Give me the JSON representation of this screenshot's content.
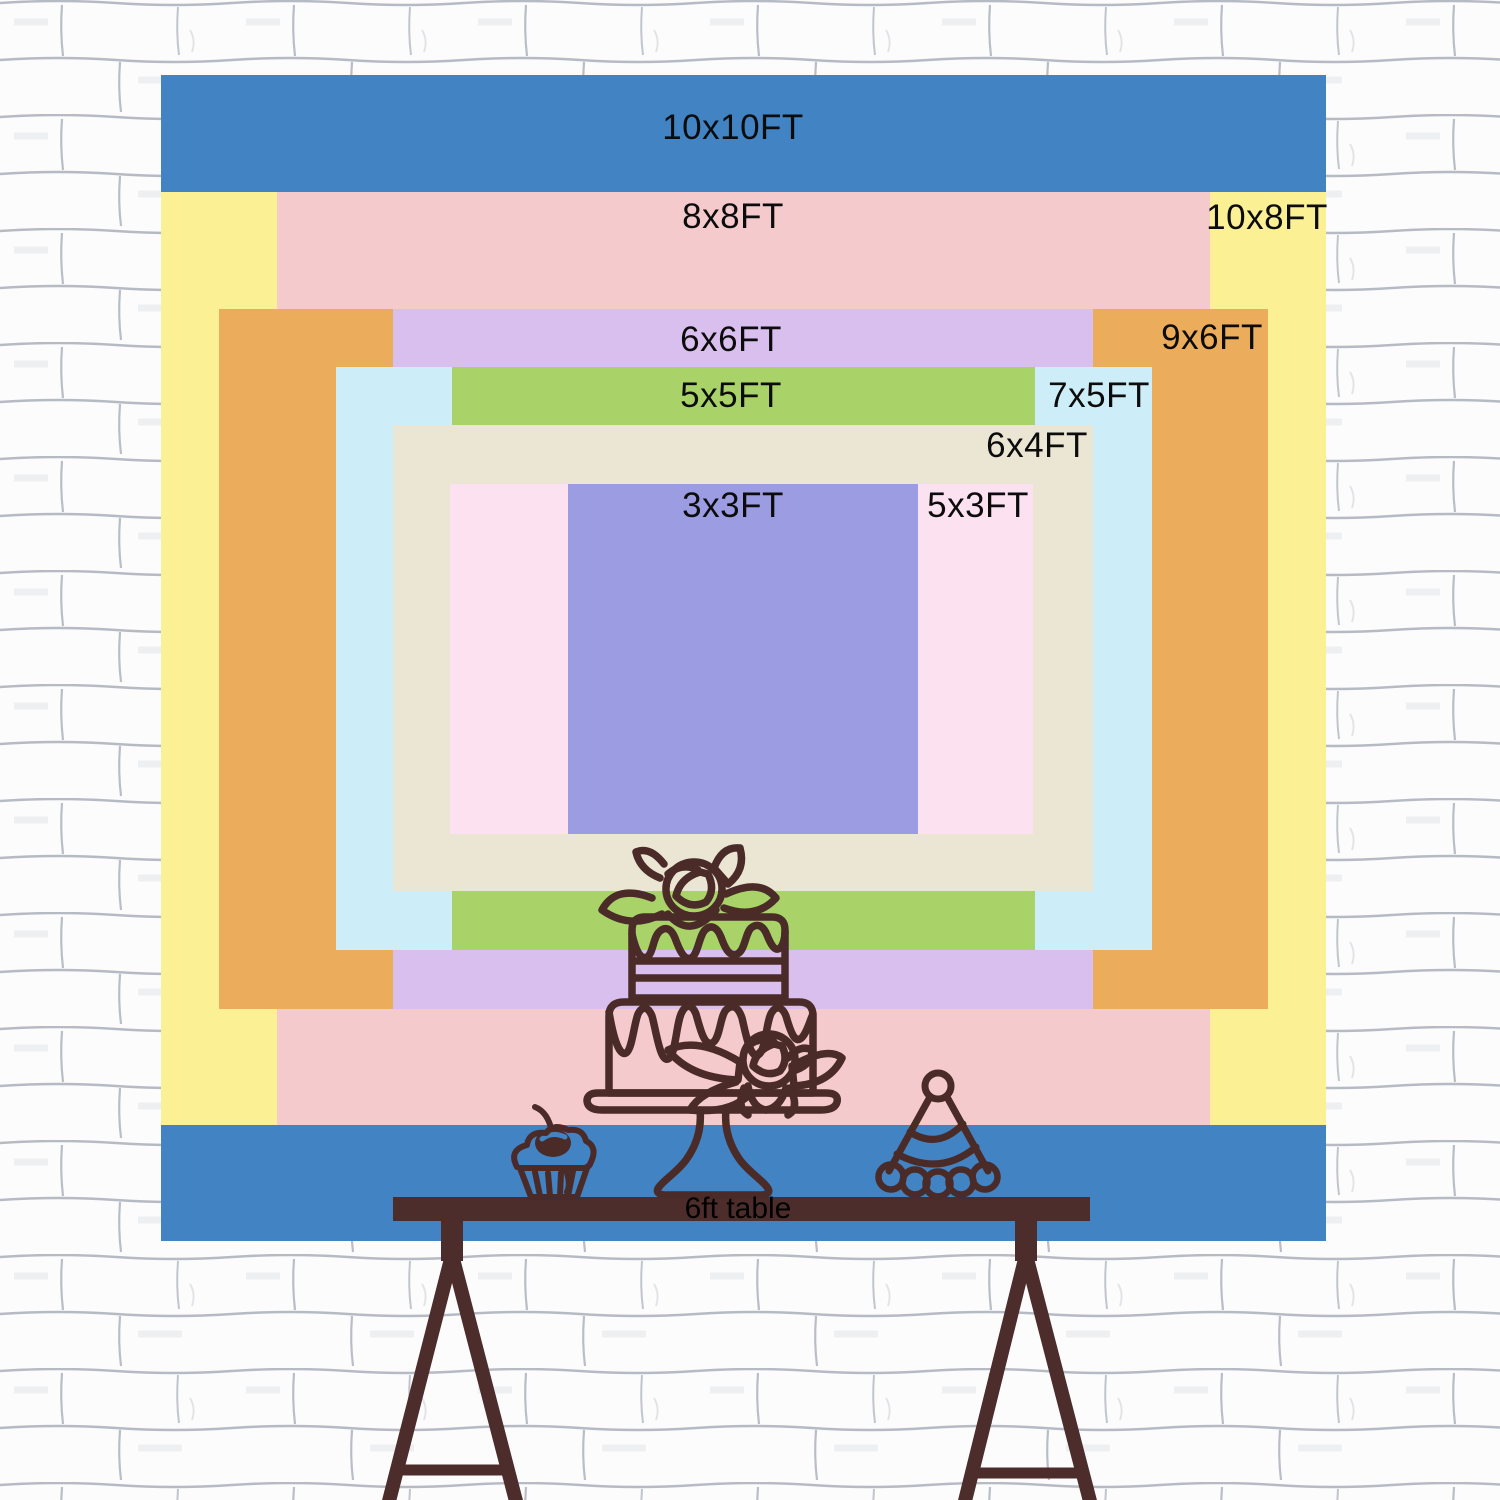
{
  "sizes": {
    "rects": [
      {
        "size": "10x10FT",
        "color": "#4183C3"
      },
      {
        "size": "10x8FT",
        "color": "#FBF094"
      },
      {
        "size": "8x8FT",
        "color": "#F4CACD"
      },
      {
        "size": "9x6FT",
        "color": "#EBAD5C"
      },
      {
        "size": "6x6FT",
        "color": "#D9BFED"
      },
      {
        "size": "7x5FT",
        "color": "#CDEEF8"
      },
      {
        "size": "5x5FT",
        "color": "#A9D369"
      },
      {
        "size": "6x4FT",
        "color": "#EBE6D4"
      },
      {
        "size": "5x3FT",
        "color": "#FCE1F0"
      },
      {
        "size": "3x3FT",
        "color": "#9C9CE2"
      }
    ],
    "label_color": "#0c0c0c"
  },
  "illustration": {
    "table_label": "6ft table",
    "table_color": "#4C2D2B",
    "line_color": "#4A2B28",
    "wall_background": "#FCFCFD",
    "wall_mortar": "#A9AEB9"
  }
}
